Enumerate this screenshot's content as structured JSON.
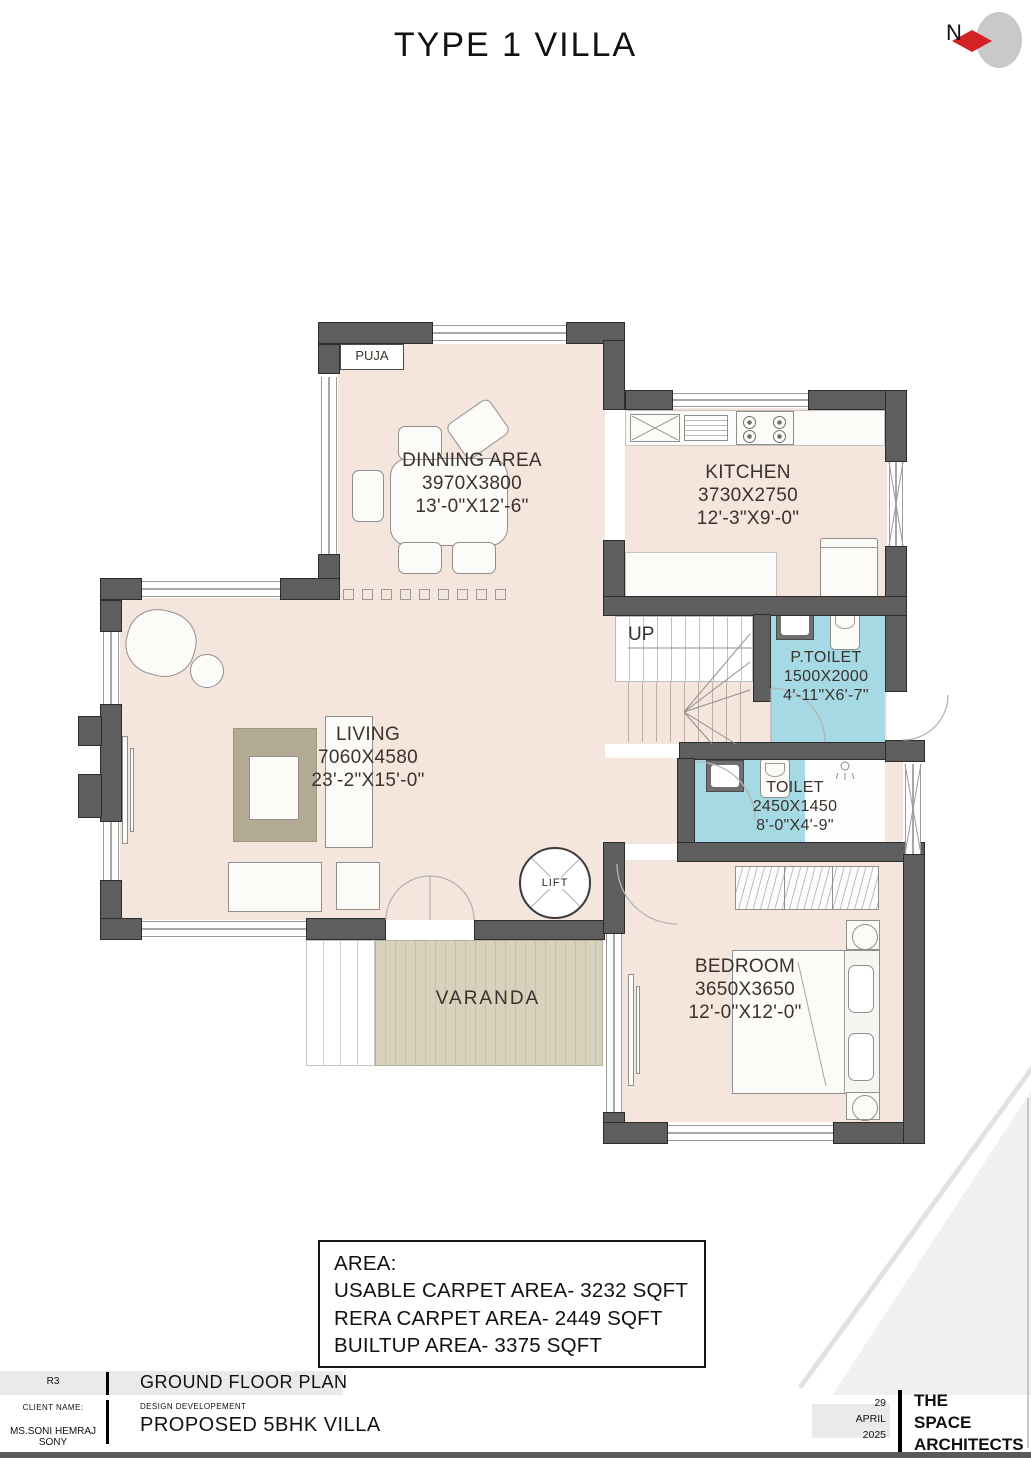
{
  "title": "TYPE 1 VILLA",
  "north_label": "N",
  "rooms": {
    "puja": {
      "name": "PUJA"
    },
    "dinning": {
      "name": "DINNING AREA",
      "dim_mm": "3970X3800",
      "dim_ft": "13'-0\"X12'-6\""
    },
    "kitchen": {
      "name": "KITCHEN",
      "dim_mm": "3730X2750",
      "dim_ft": "12'-3\"X9'-0\""
    },
    "p_toilet": {
      "name": "P.TOILET",
      "dim_mm": "1500X2000",
      "dim_ft": "4'-11\"X6'-7\""
    },
    "toilet": {
      "name": "TOILET",
      "dim_mm": "2450X1450",
      "dim_ft": "8'-0\"X4'-9\""
    },
    "living": {
      "name": "LIVING",
      "dim_mm": "7060X4580",
      "dim_ft": "23'-2\"X15'-0\""
    },
    "bedroom": {
      "name": "BEDROOM",
      "dim_mm": "3650X3650",
      "dim_ft": "12'-0\"X12'-0\""
    },
    "varanda": {
      "name": "VARANDA"
    },
    "stairs": {
      "name": "UP"
    },
    "lift": {
      "name": "LIFT"
    }
  },
  "area_box": {
    "heading": "AREA:",
    "usable": "USABLE CARPET AREA- 3232 SQFT",
    "rera": "RERA CARPET AREA- 2449 SQFT",
    "builtup": "BUILTUP AREA- 3375 SQFT"
  },
  "title_block": {
    "revision": "R3",
    "drawing_title": "GROUND FLOOR PLAN",
    "client_label": "CLIENT NAME:",
    "client_name": "MS.SONI HEMRAJ SONY",
    "stage_label": "DESIGN DEVELOPEMENT",
    "project_title": "PROPOSED 5BHK VILLA",
    "date": {
      "day": "29",
      "month": "APRIL",
      "year": "2025"
    },
    "firm": [
      "THE",
      "SPACE",
      "ARCHITECTS"
    ]
  },
  "colors": {
    "wall": "#5e5e5e",
    "floor": "#f4e5dd",
    "toilet_floor": "#a5d9e4",
    "veranda_floor": "#d6d2bc",
    "north_red": "#d42127",
    "titlebar_gray": "#eaeaea"
  }
}
